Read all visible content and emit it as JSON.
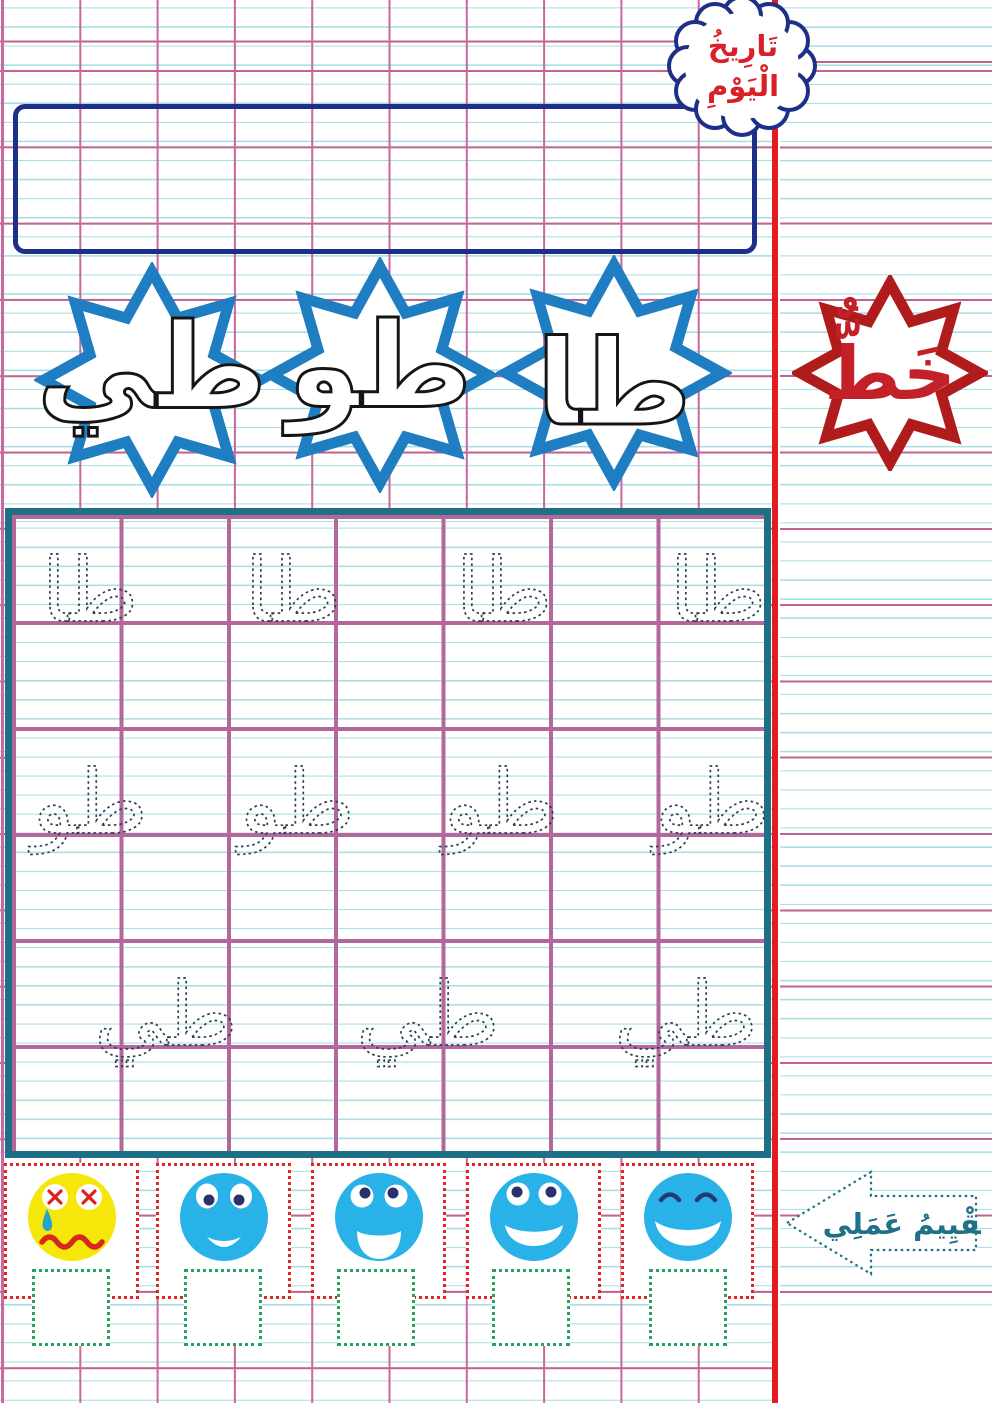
{
  "colors": {
    "grid_pink": "#c9699d",
    "grid_cyan": "#a5dde2",
    "margin_red": "#e31b23",
    "navy_outline": "#1d2f87",
    "cloud_text_red": "#d92027",
    "star_blue": "#1f7dc2",
    "letter_outline": "#151515",
    "khat_star_red": "#b01b1b",
    "khat_text_red": "#c32027",
    "practice_border_teal": "#1d7086",
    "practice_grid_mauve": "#b3679b",
    "trace_dotted": "#2b4049",
    "eval_box_red": "#e32424",
    "check_green": "#26a35c",
    "face_blue": "#29b2e8",
    "face_yellow": "#f6e60a",
    "arrow_teal": "#1e7187"
  },
  "cloud": {
    "line1": "تَارِيخُ",
    "line2": "الْيَوْمِ"
  },
  "date_box": {
    "value": ""
  },
  "letter_stars": {
    "items": [
      {
        "label": "طي"
      },
      {
        "label": "طو"
      },
      {
        "label": "طا"
      }
    ]
  },
  "khat_star": {
    "label": "خَطٌّ"
  },
  "practice": {
    "rows": [
      {
        "char": "طا",
        "count": 4
      },
      {
        "char": "طو",
        "count": 4
      },
      {
        "char": "طي",
        "count": 3
      }
    ]
  },
  "evaluation": {
    "arrow_label": "تَقْيِيمُ عَمَلِي",
    "faces": [
      {
        "name": "crying-face",
        "mood": "very-sad"
      },
      {
        "name": "sad-face",
        "mood": "sad"
      },
      {
        "name": "neutral-face",
        "mood": "okay"
      },
      {
        "name": "happy-face",
        "mood": "happy"
      },
      {
        "name": "delighted-face",
        "mood": "very-happy"
      }
    ]
  }
}
